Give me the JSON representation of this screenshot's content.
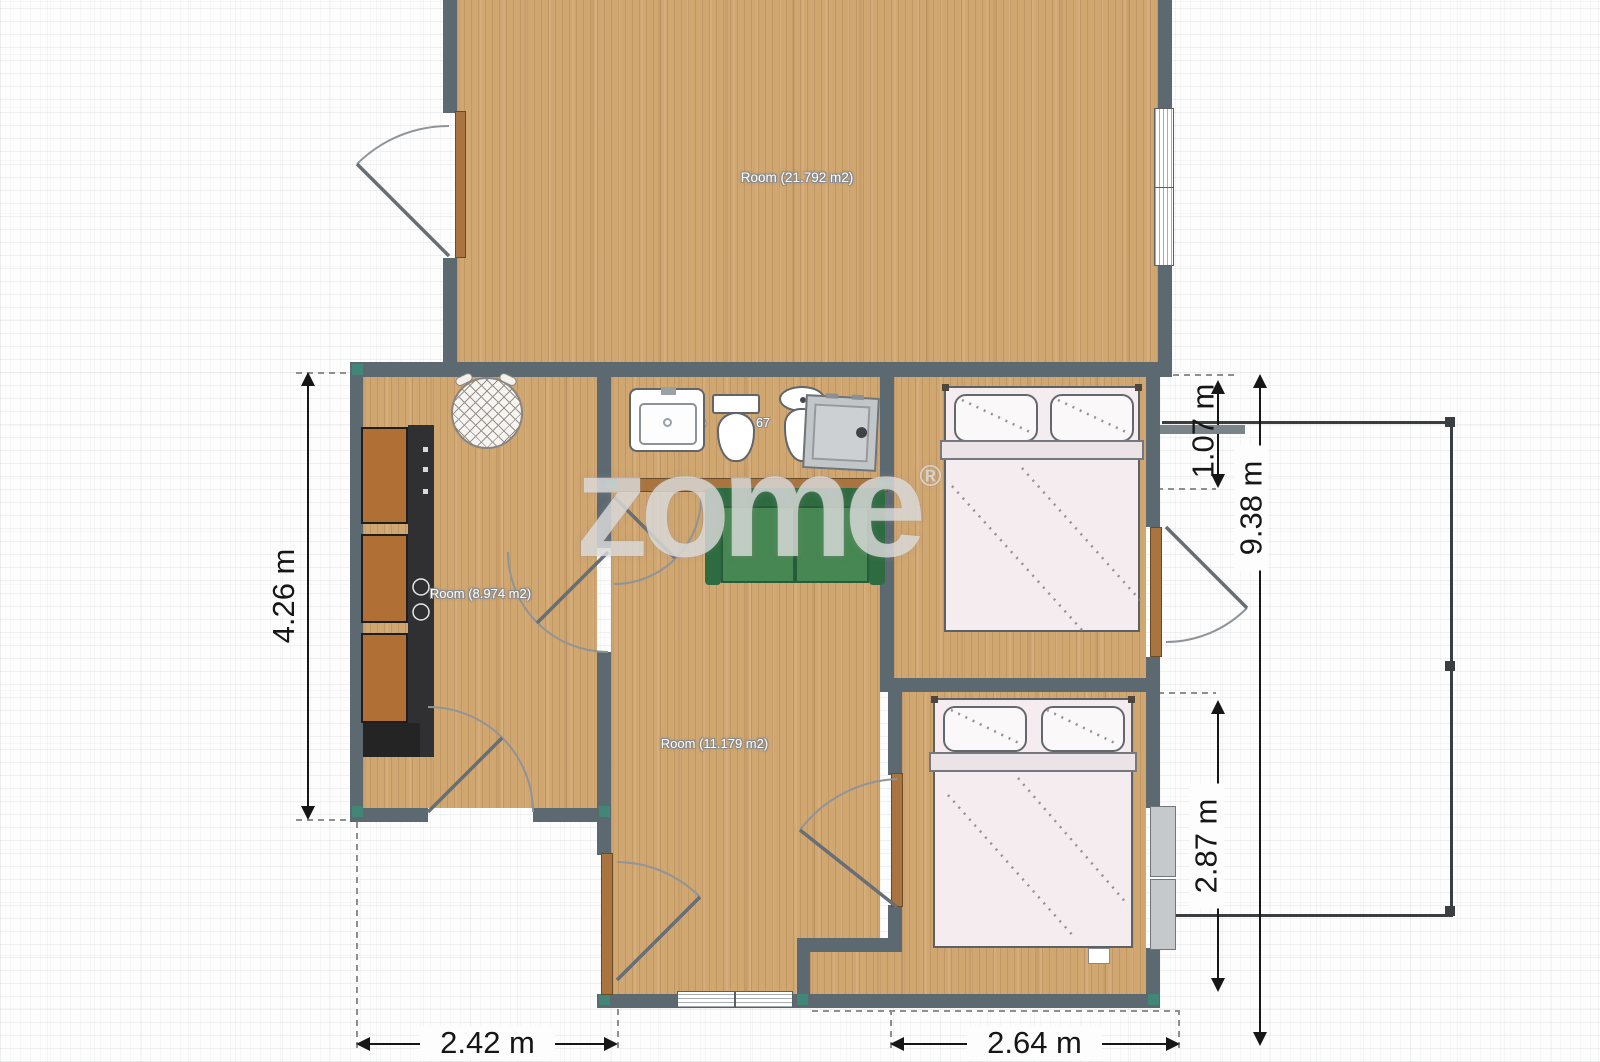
{
  "watermark": {
    "text": "zome",
    "registered": "®"
  },
  "rooms": {
    "living": "Room (21.792 m2)",
    "kitchen": "Room (8.974 m2)",
    "hall": "Room (11.179 m2)",
    "bath_fragment_left": "Ro",
    "bath_fragment_right": "67"
  },
  "dimensions": {
    "left": "4.26 m",
    "bottom_left": "2.42 m",
    "bottom_right": "2.64 m",
    "right_upper": "1.07 m",
    "right_total": "9.38 m",
    "right_lower": "2.87 m"
  },
  "colors": {
    "wall": "#5d6971",
    "floor_wood": "#d0a671",
    "sofa_green": "#478753",
    "cabinet_orange": "#b06f35",
    "door_brown": "#a9743f",
    "joint_teal": "#3f8a78",
    "annotation": "#161616"
  }
}
